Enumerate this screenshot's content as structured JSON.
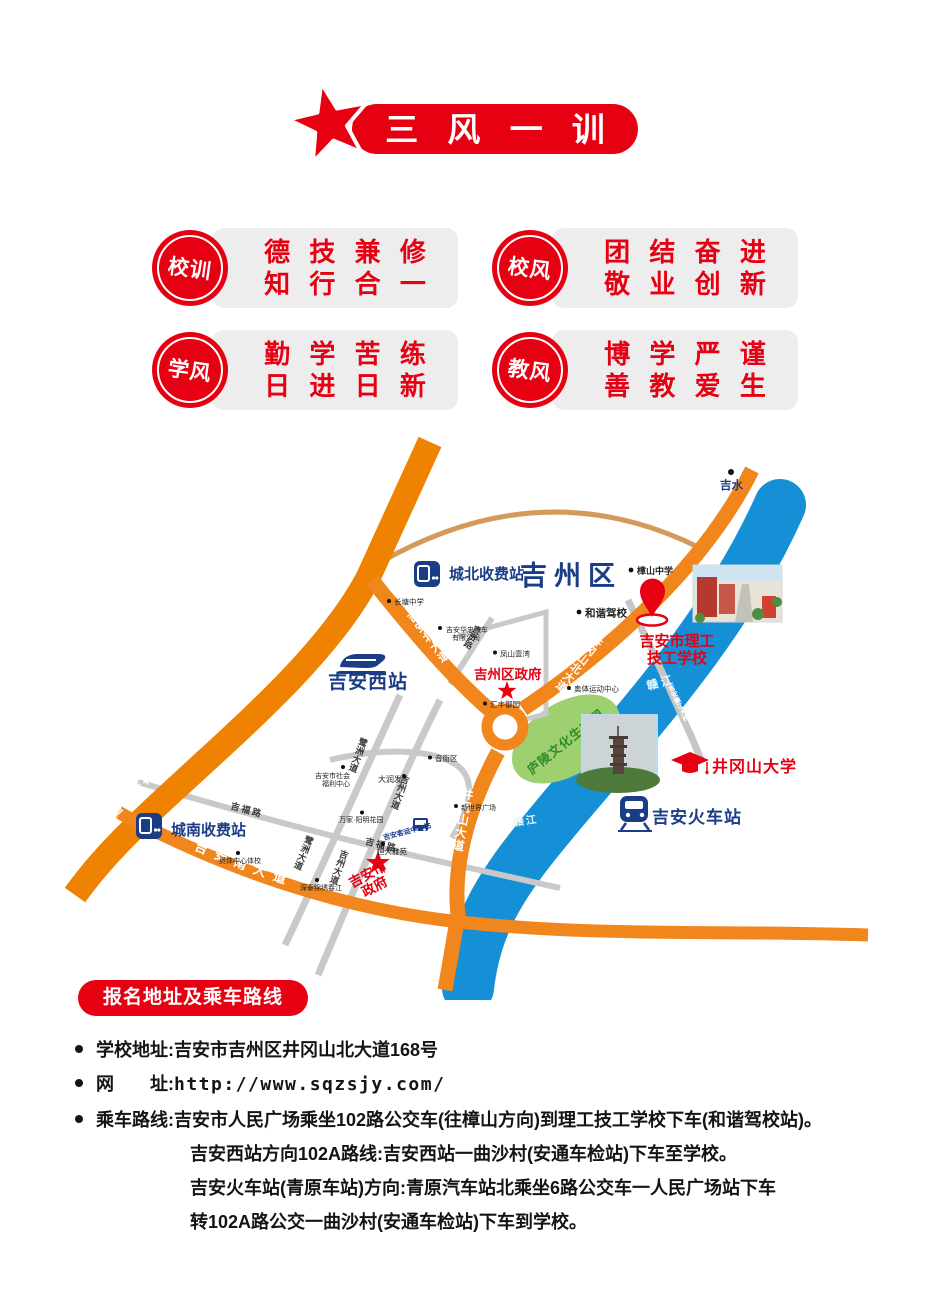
{
  "colors": {
    "red": "#e60012",
    "navy": "#1b3c87",
    "orange": "#f08300",
    "river": "#1590d6",
    "park_green": "#9ed06f",
    "gray_road": "#c9c9c9"
  },
  "header": {
    "title": "三 风 一 训"
  },
  "badges": [
    {
      "title": "校训",
      "line1": "德 技 兼 修",
      "line2": "知 行 合 一"
    },
    {
      "title": "校风",
      "line1": "团 结 奋 进",
      "line2": "敬 业 创 新"
    },
    {
      "title": "学风",
      "line1": "勤 学 苦 练",
      "line2": "日 进 日 新"
    },
    {
      "title": "教风",
      "line1": "博 学 严 谨",
      "line2": "善 教 爱 生"
    }
  ],
  "map": {
    "district": "吉州区",
    "jishui": "吉水",
    "highway": "樟吉高速",
    "toll_north": "城北收费站",
    "toll_south": "城南收费站",
    "west_station": "吉安西站",
    "railway_station": "吉安火车站",
    "bus_center": "吉安客运中心站",
    "district_gov": "吉州区政府",
    "city_gov_line1": "吉安市",
    "city_gov_line2": "政府",
    "school_line1": "吉安市理工",
    "school_line2": "技工学校",
    "university": "井冈山大学",
    "park": "庐陵文化生态园",
    "river": "赣江",
    "roads": {
      "jian_north": "吉安北大道",
      "jinggangshan_north": "井冈山北大道",
      "jinggangshan": "井冈山大道",
      "jian_south": "吉安南大道",
      "jifu": "吉福路",
      "jigui": "吉贵路",
      "luzhou": "鹭洲大道",
      "jizhou": "吉州大道",
      "jinzhang": "金樟大道",
      "bridge": "吉安赣江大桥"
    },
    "poi": {
      "hexie": "和谐驾校",
      "zhangshan": "樟山中学",
      "changtang": "长塘中学",
      "huazhong1": "吉安华忠汽车",
      "huazhong2": "有限公司",
      "fengshan": "凤山壹湾",
      "huifeng": "汇丰御园",
      "aoti": "奥体运动中心",
      "welfare1": "吉安市社会",
      "welfare2": "福利中心",
      "darunfa": "大润发",
      "yinjiequ": "音街区",
      "wanjia": "万家·阳明花园",
      "hengda": "恒大雅苑",
      "aotixiao": "奥体中心体校",
      "shentai": "深泰锦绣春江",
      "xinshijie": "新世界广场"
    }
  },
  "footer": {
    "section_title": "报名地址及乘车路线",
    "address": "学校地址:吉安市吉州区井冈山北大道168号",
    "website_label": "网　　址:",
    "website_url": "http://www.sqzsjy.com/",
    "route1": "乘车路线:吉安市人民广场乘坐102路公交车(往樟山方向)到理工技工学校下车(和谐驾校站)。",
    "route2": "吉安西站方向102A路线:吉安西站一曲沙村(安通车检站)下车至学校。",
    "route3": "吉安火车站(青原车站)方向:青原汽车站北乘坐6路公交车一人民广场站下车",
    "route4": "转102A路公交一曲沙村(安通车检站)下车到学校。"
  }
}
